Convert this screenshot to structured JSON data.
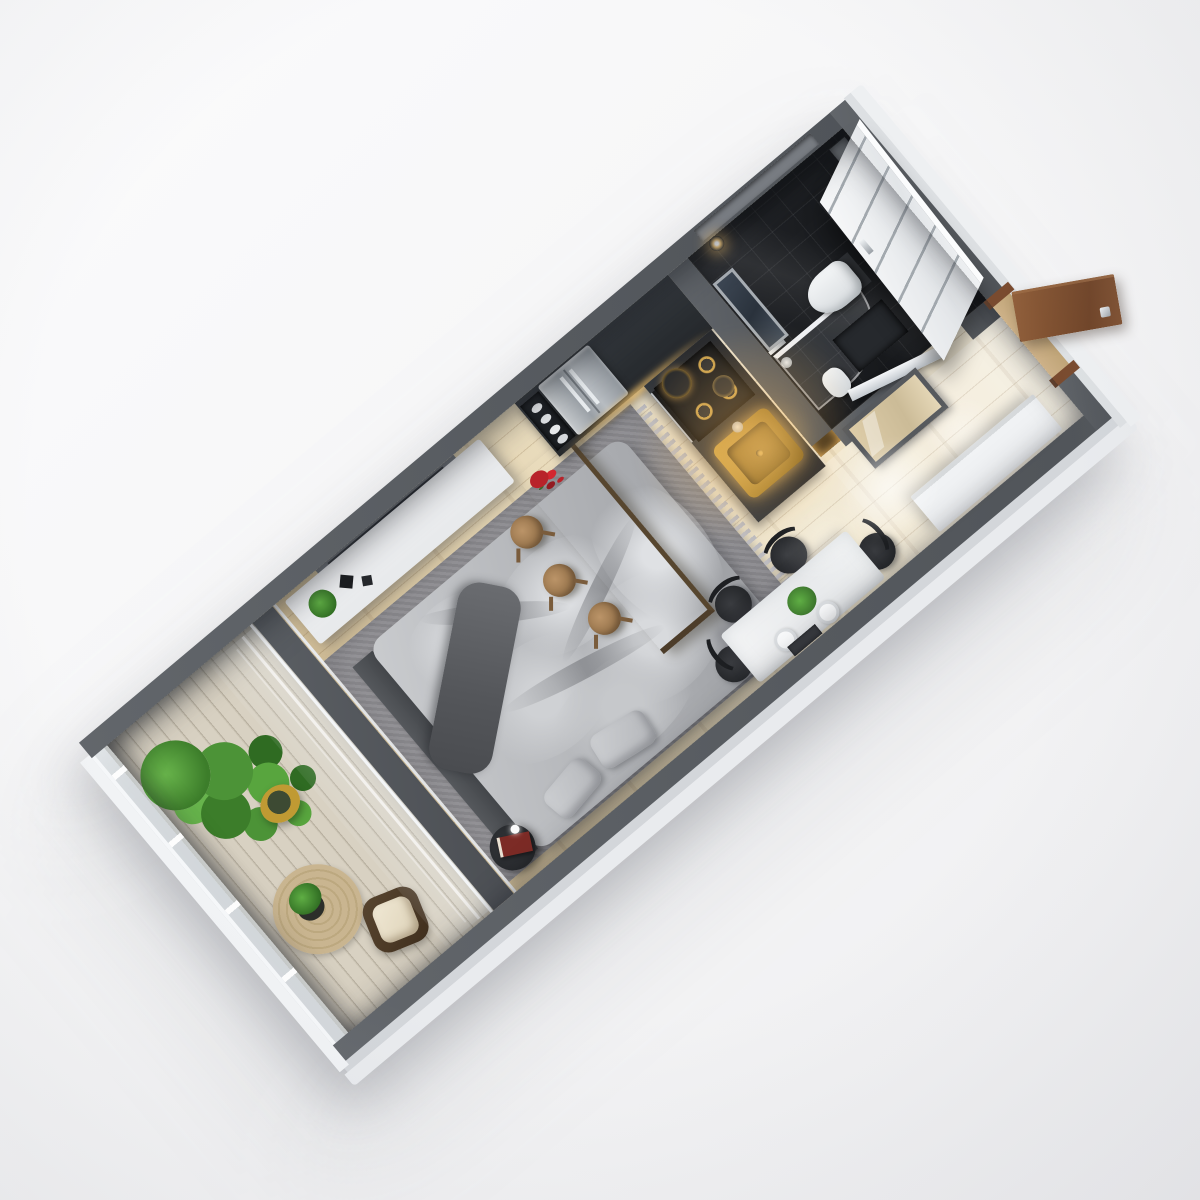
{
  "scene": {
    "kind": "photorealistic 3D floor plan render",
    "view": "top-down isometric, unit rotated about 40 degrees",
    "background": "plain light studio backdrop, soft cast shadow under the model"
  },
  "colors": {
    "background": "#f6f6f7",
    "wall_top": "#5b5f64",
    "wall_outer_face": "#e9ebee",
    "floor_wood": "#e7d8b6",
    "balcony_deck": "#d6cfc0",
    "bathroom_tile": "#1d1f23",
    "rug_gray": "#97969a",
    "bedding_gray": "#b9bbbf",
    "blanket_dark": "#5c5e63",
    "white_furniture": "#eff1f3",
    "rustic_wood_table": "#7f6b50",
    "stool_wood": "#ae8a61",
    "chair_black": "#2a2c2f",
    "cabinet_charcoal": "#2f3337",
    "stainless_steel": "#b7bcc1",
    "brass_sink": "#c0953c",
    "warm_glow": "#ffc168",
    "entry_door_wood": "#845432",
    "plant_green": "#4c9337",
    "gold_pot": "#c09a33",
    "jute_rug": "#c4b08a",
    "wicker_brown": "#4e3c2b",
    "cushion_cream": "#ebe2cd"
  },
  "rooms": [
    {
      "id": "balcony",
      "label": "Balcony",
      "items": [
        "ficus plant in gold pot",
        "round jute rug",
        "small potted plant",
        "rattan armchair with cream cushion",
        "glass balustrade",
        "whitewashed deck boards"
      ]
    },
    {
      "id": "living",
      "label": "Living / Sleeping Area",
      "items": [
        "wall-mounted TV",
        "white media sideboard",
        "potted plant and black vases",
        "gray area rug with fringe",
        "unmade bed with gray duvet",
        "dark gray throw blanket",
        "two pillows",
        "dark headboard bench",
        "round black side table",
        "red book",
        "glass partition to balcony"
      ]
    },
    {
      "id": "dining",
      "label": "Dining Area",
      "items": [
        "rustic wood bar table",
        "red rose bouquet",
        "three round wood stools",
        "white stone dining table",
        "yellow flower centerpiece",
        "two place settings",
        "cutlery tray",
        "four black spindle chairs"
      ]
    },
    {
      "id": "kitchen",
      "label": "Kitchen",
      "items": [
        "charcoal cabinet run",
        "open shelf with plates",
        "stainless french-door refrigerator",
        "under-cabinet warm lighting",
        "gas cooktop with pots",
        "built-in oven",
        "brass sink with faucet",
        "warm lit shelf niche"
      ]
    },
    {
      "id": "bathroom",
      "label": "Bathroom",
      "items": [
        "black gloss tiles",
        "wall-hung toilet",
        "glass shower screen",
        "hand shower",
        "small white basin",
        "mirror radiator panel",
        "two chrome sconces",
        "recessed niche shelf",
        "white panel door leaning",
        "dark bath mat"
      ]
    },
    {
      "id": "hall",
      "label": "Entry Hall",
      "items": [
        "open wooden entry door with chrome handle",
        "wood door frame",
        "framed mirror with chrome rail",
        "white wardrobe",
        "light wood plank floor",
        "bright ceiling light pool"
      ]
    }
  ]
}
